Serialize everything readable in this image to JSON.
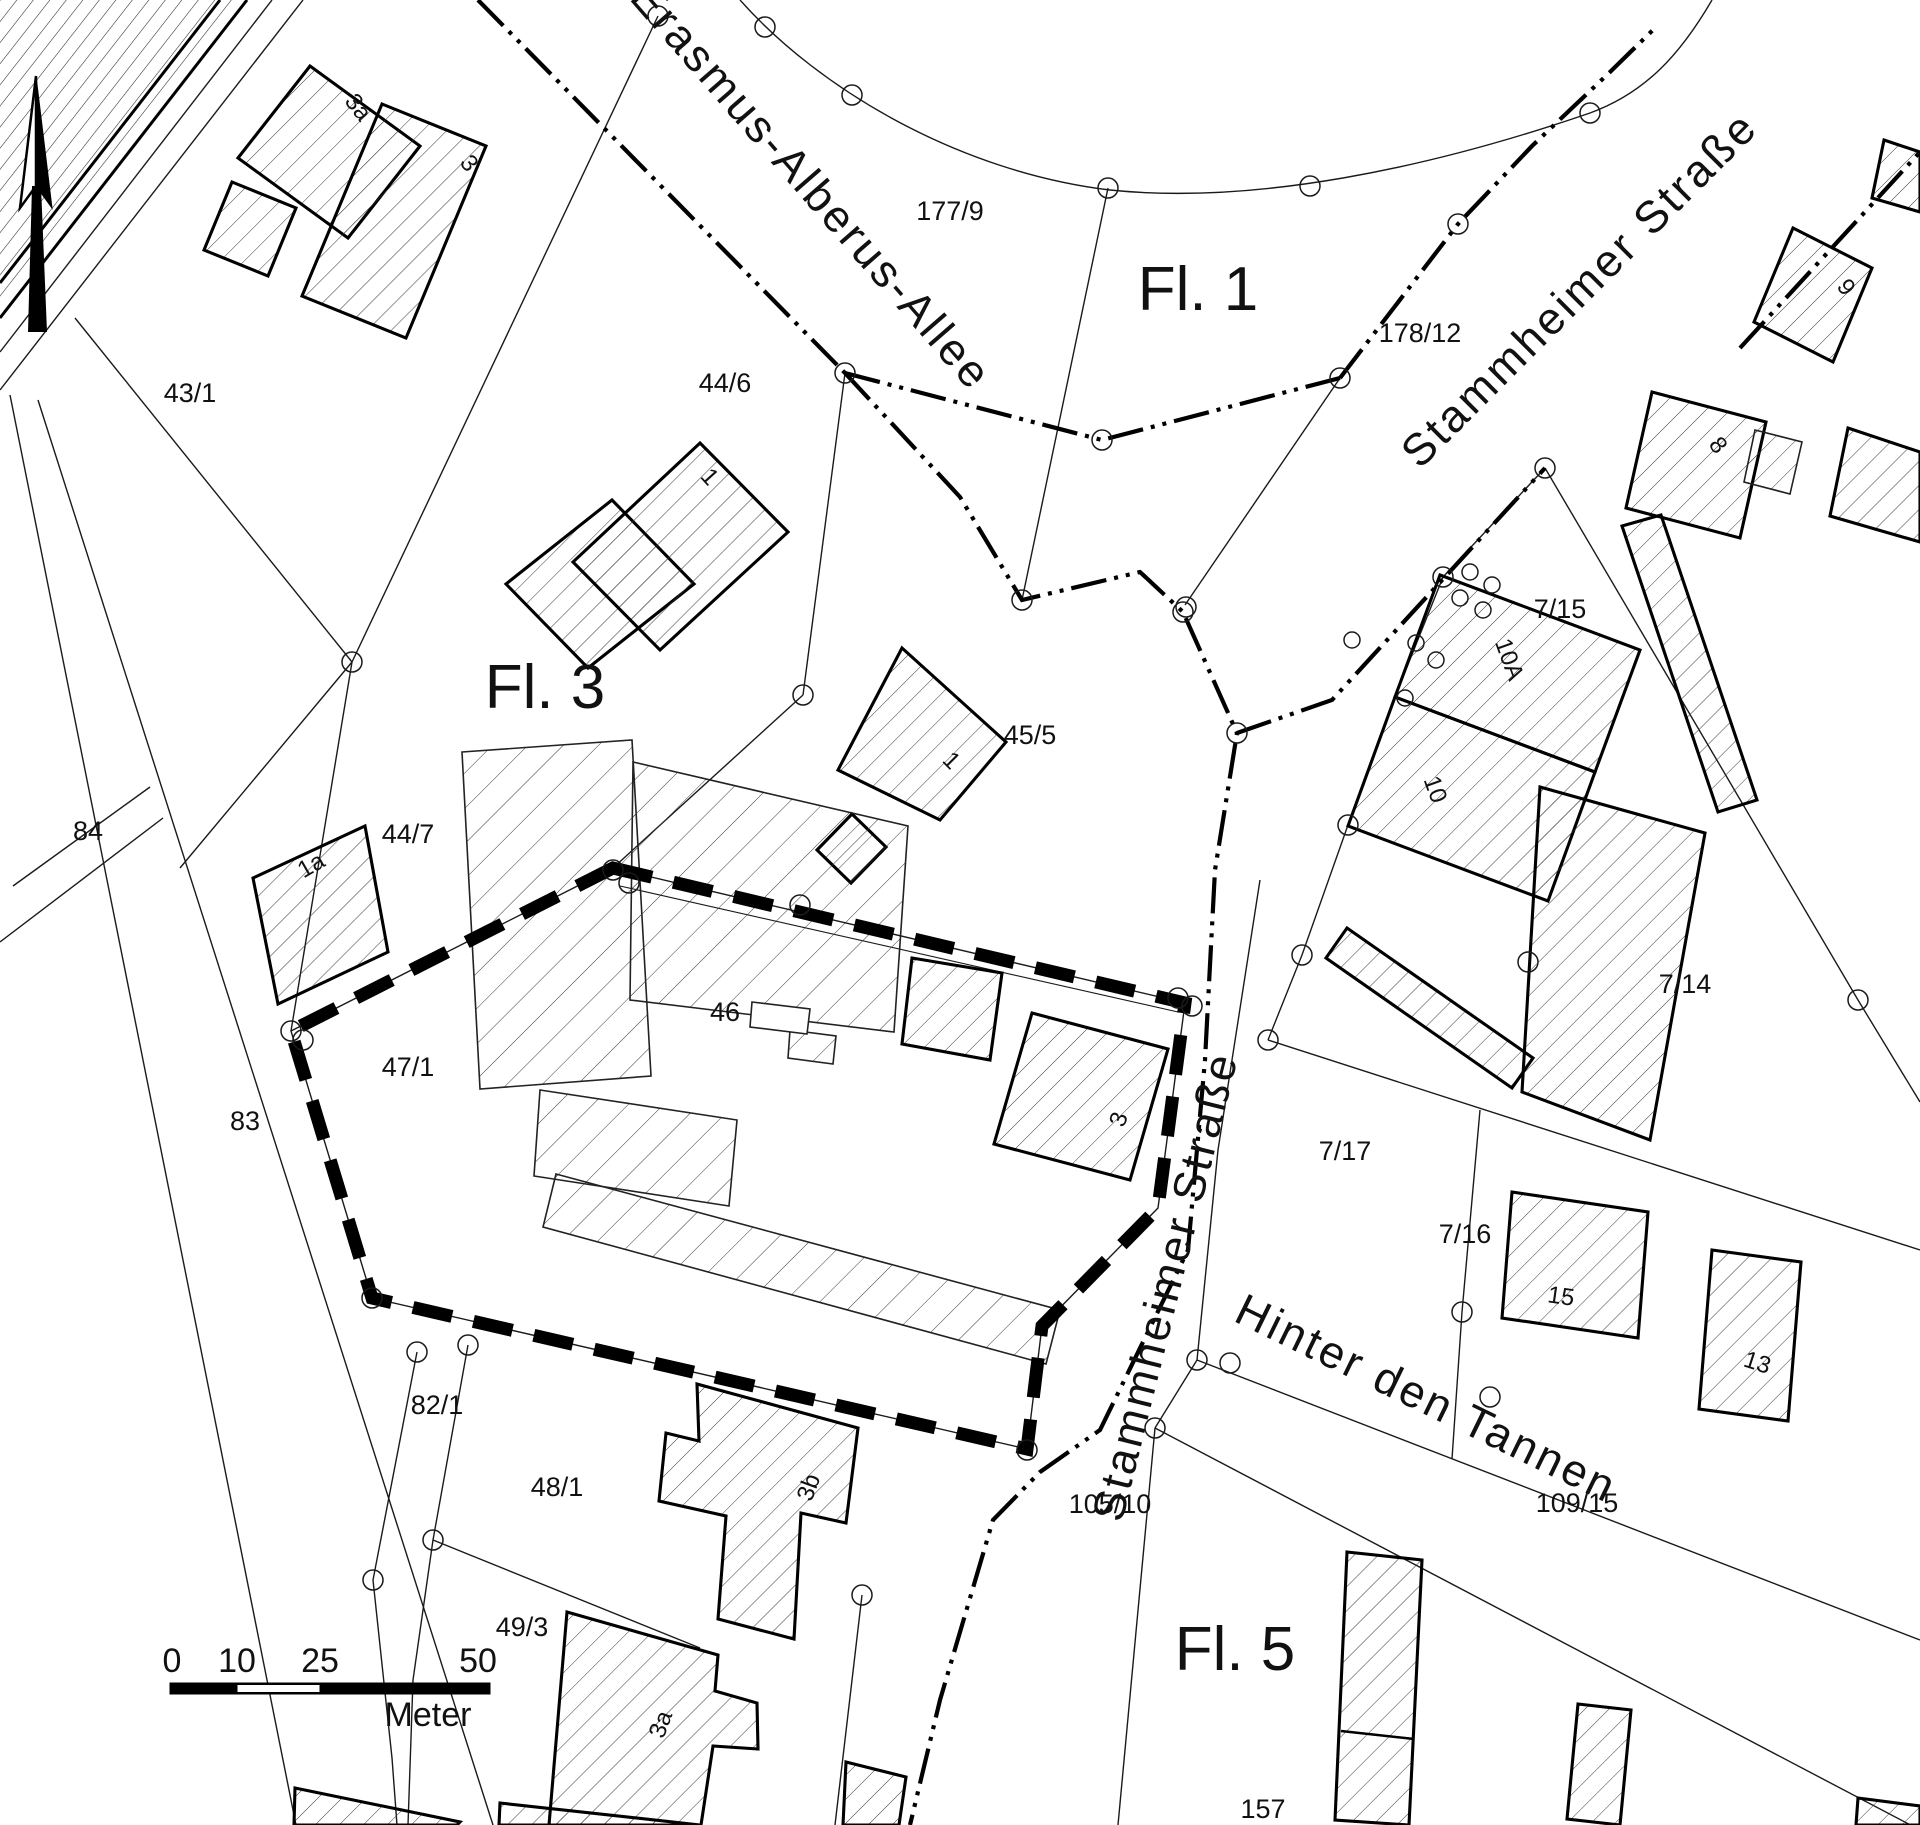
{
  "labels": {
    "p43_1": "43/1",
    "b3a_top": "3a",
    "b3_top": "3",
    "erasmus": "Erasmus-Alberus-Allee",
    "p177_9": "177/9",
    "fl1": "Fl. 1",
    "p178_12": "178/12",
    "stamm_ne": "Stammheimer Straße",
    "b9": "9",
    "b8": "8",
    "p44_6": "44/6",
    "b1_446": "1",
    "fl3": "Fl. 3",
    "p45_5": "45/5",
    "b1_455": "1",
    "p44_7": "44/7",
    "b1a": "1a",
    "p47_1": "47/1",
    "p46": "46",
    "b3_main": "3",
    "b10a": "10A",
    "b10": "10",
    "p7_15": "7/15",
    "p7_14": "7/14",
    "p7_17": "7/17",
    "p7_16": "7/16",
    "b15": "15",
    "b13": "13",
    "hinter": "Hinter den Tannen",
    "p109_15": "109/15",
    "stamm_s": "Stammheimer Straße",
    "p105_10": "105/10",
    "p82_1": "82/1",
    "p48_1": "48/1",
    "p49_3": "49/3",
    "b3b": "3b",
    "b3a_s": "3a",
    "fl5": "Fl. 5",
    "p157": "157",
    "p83": "83",
    "p84": "84"
  },
  "scale_bar": {
    "n0": "0",
    "n10": "10",
    "n25": "25",
    "n50": "50",
    "unit": "Meter"
  },
  "colors": {
    "ink": "#111111",
    "paper": "#ffffff",
    "boundary": "#000000"
  }
}
